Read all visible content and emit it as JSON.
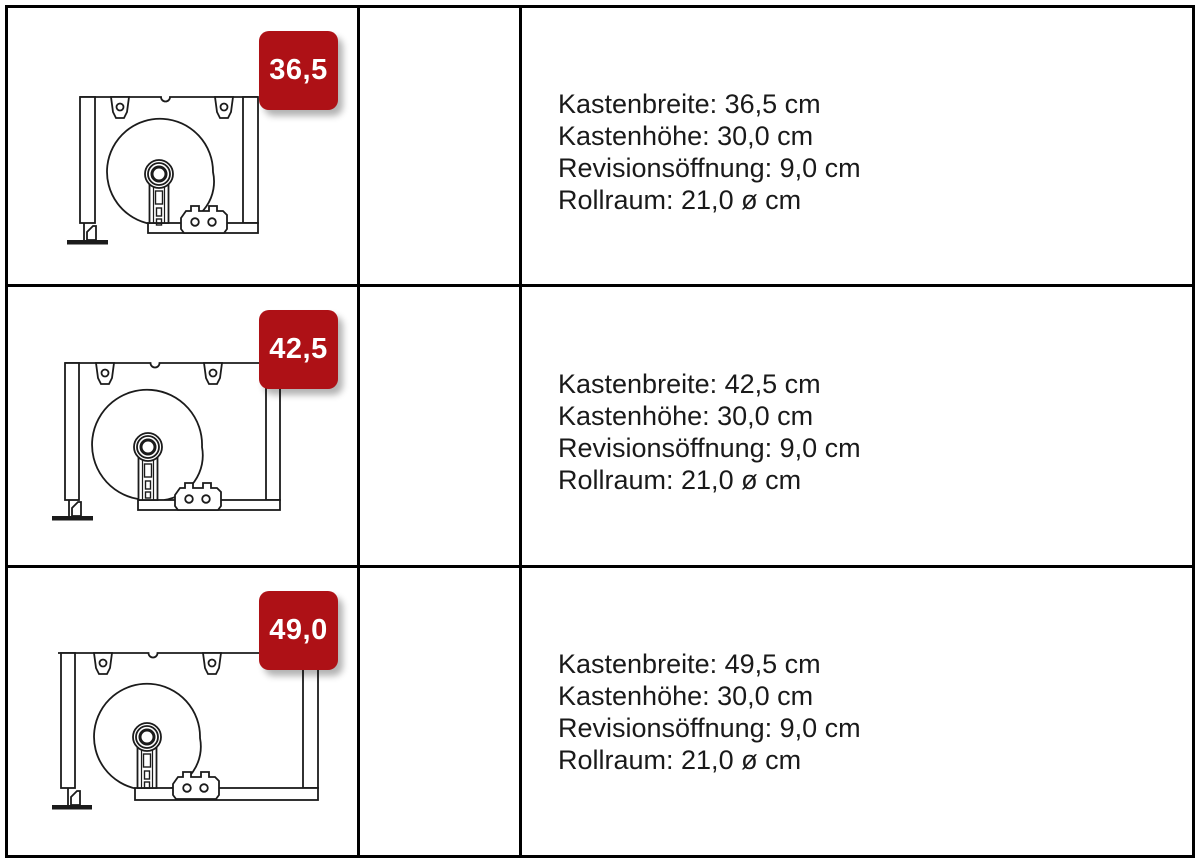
{
  "colors": {
    "badge_red": "#ae1116",
    "diagram_line": "#1b1b1b",
    "table_border": "#000000",
    "text": "#1a1a1a"
  },
  "rows": [
    {
      "badge": "36,5",
      "diagram": "rollladenkasten-cross-section-36-5",
      "specs": [
        "Kastenbreite: 36,5 cm",
        "Kastenhöhe: 30,0 cm",
        "Revisionsöffnung: 9,0 cm",
        "Rollraum: 21,0 ø cm"
      ]
    },
    {
      "badge": "42,5",
      "diagram": "rollladenkasten-cross-section-42-5",
      "specs": [
        "Kastenbreite: 42,5 cm",
        "Kastenhöhe: 30,0 cm",
        "Revisionsöffnung: 9,0 cm",
        "Rollraum: 21,0 ø cm"
      ]
    },
    {
      "badge": "49,0",
      "diagram": "rollladenkasten-cross-section-49-0",
      "specs": [
        "Kastenbreite: 49,5 cm",
        "Kastenhöhe: 30,0 cm",
        "Revisionsöffnung: 9,0 cm",
        "Rollraum: 21,0 ø cm"
      ]
    }
  ]
}
